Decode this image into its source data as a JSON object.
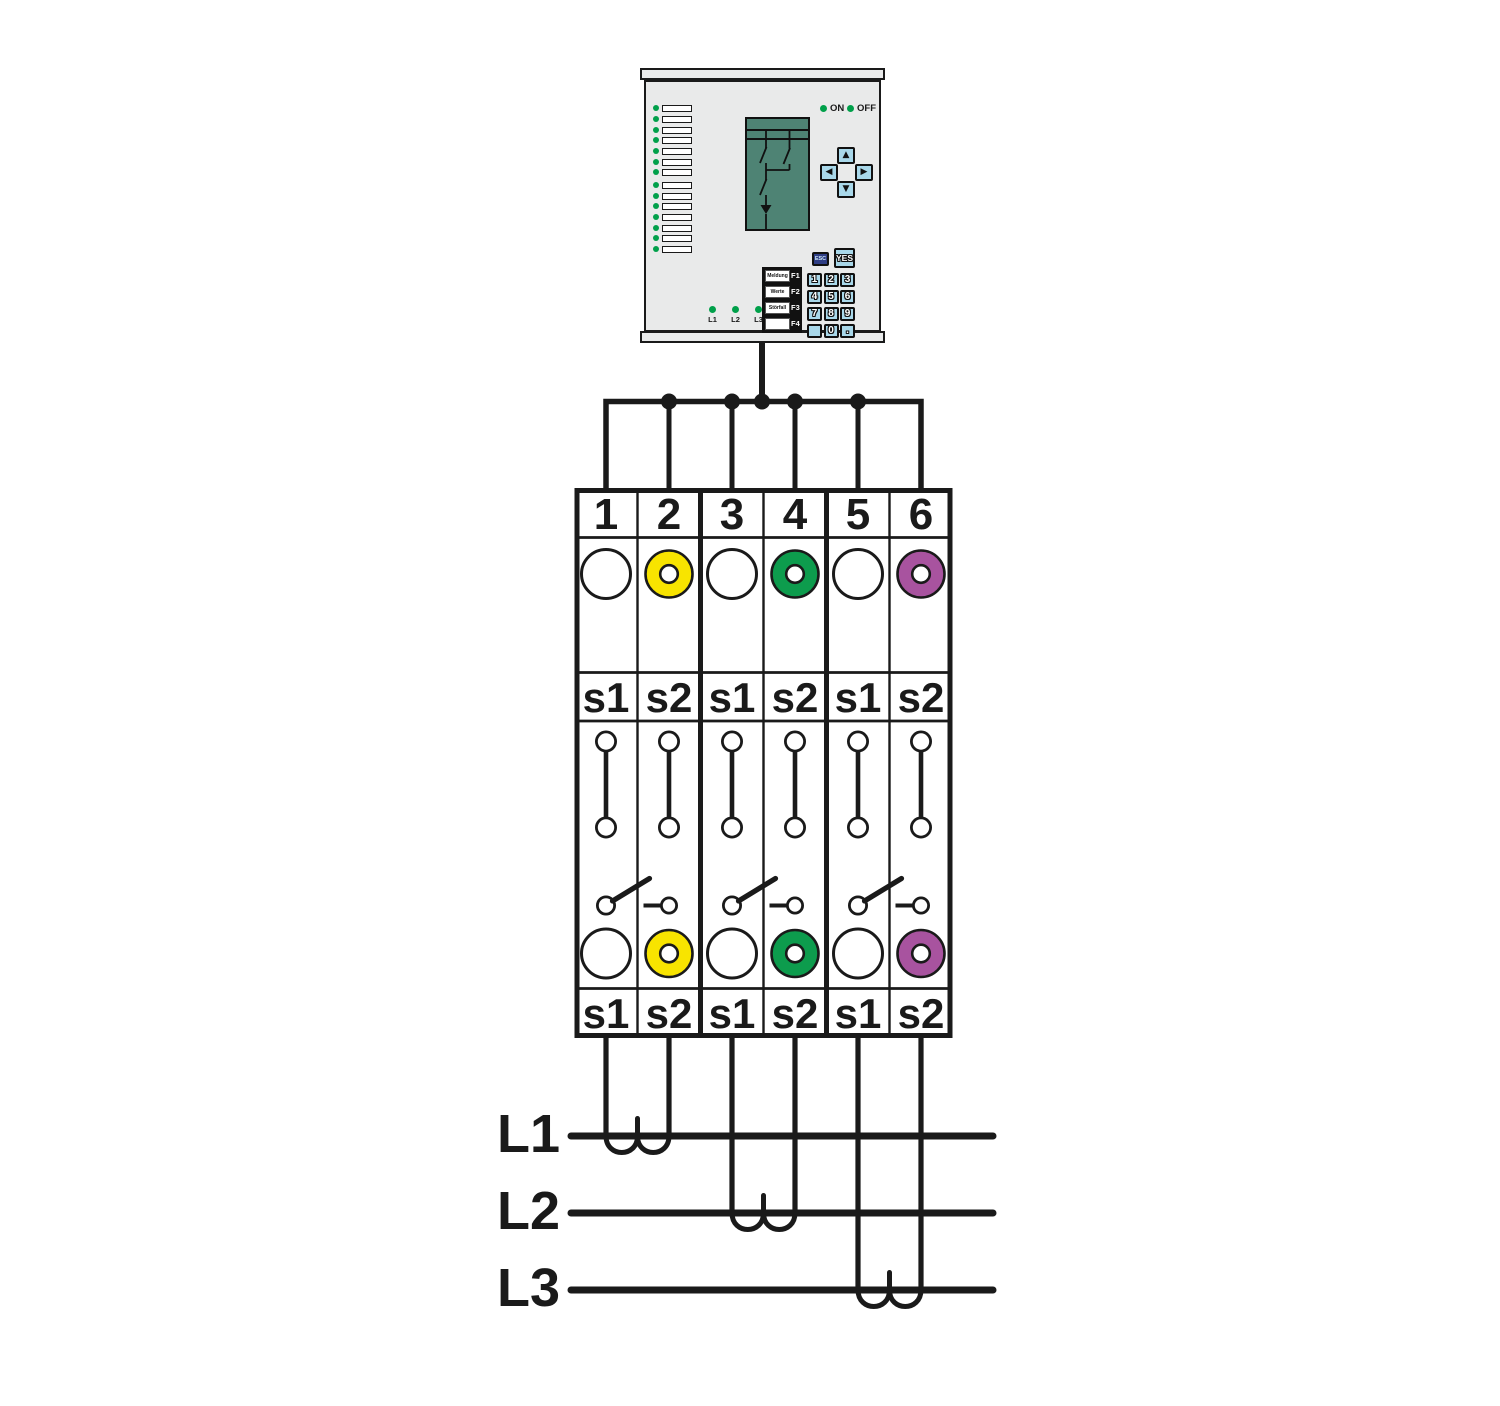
{
  "device": {
    "status_on": "ON",
    "status_off": "OFF",
    "arrows": [
      "▲",
      "◀",
      "▶",
      "▼"
    ],
    "esc": "ESC",
    "yes": "YES",
    "fkeys": [
      {
        "label": "Meldung",
        "key": "F1"
      },
      {
        "label": "Werte",
        "key": "F2"
      },
      {
        "label": "Störfall",
        "key": "F3"
      },
      {
        "label": "",
        "key": "F4"
      }
    ],
    "keypad": [
      "1",
      "2",
      "3",
      "4",
      "5",
      "6",
      "7",
      "8",
      "9",
      "",
      "0",
      "."
    ],
    "phase_leds": [
      "L1",
      "L2",
      "L3"
    ]
  },
  "terminal": {
    "numbers": [
      "1",
      "2",
      "3",
      "4",
      "5",
      "6"
    ],
    "upper_labels": [
      "s1",
      "s2",
      "s1",
      "s2",
      "s1",
      "s2"
    ],
    "lower_labels": [
      "s1",
      "s2",
      "s1",
      "s2",
      "s1",
      "s2"
    ]
  },
  "power_lines": {
    "labels": [
      "L1",
      "L2",
      "L3"
    ]
  },
  "colors": {
    "panel_grey": "#e9eaea",
    "display_green": "#4e8374",
    "key_blue": "#a9d8ea",
    "esc_navy": "#2f3e85",
    "led_green": "#00a04a",
    "ring_yellow": "#f8e400",
    "ring_green": "#0d9c4d",
    "ring_purple": "#a8539f",
    "ink": "#1a1a1a"
  }
}
